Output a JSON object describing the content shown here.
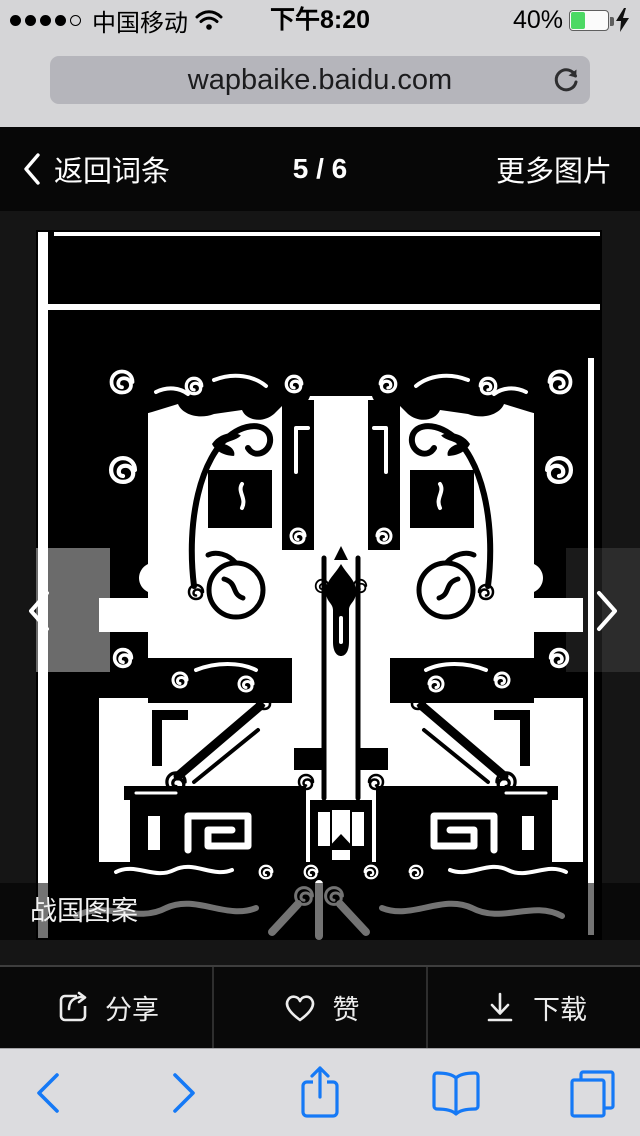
{
  "status_bar": {
    "carrier": "中国移动",
    "time": "下午8:20",
    "battery_percent": "40%",
    "battery_level": 0.4,
    "signal": {
      "filled": 4,
      "total": 5
    },
    "icons": [
      "signal-dots",
      "wifi-icon",
      "battery-icon",
      "charging-bolt-icon"
    ]
  },
  "address_bar": {
    "url": "wapbaike.baidu.com",
    "icons": [
      "refresh-icon"
    ]
  },
  "gallery_header": {
    "back_label": "返回词条",
    "counter": "5 / 6",
    "more_images_label": "更多图片",
    "icons": [
      "chevron-left-icon"
    ]
  },
  "image_viewer": {
    "caption": "战国图案",
    "nav_icons": [
      "chevron-left-icon",
      "chevron-right-icon"
    ],
    "image_description": "black-and-white symmetrical Warring States ornament scan"
  },
  "action_bar": {
    "share_label": "分享",
    "like_label": "赞",
    "download_label": "下载",
    "icons": [
      "share-box-icon",
      "heart-icon",
      "download-icon"
    ]
  },
  "safari_toolbar": {
    "icons": [
      "back-chevron-icon",
      "forward-chevron-icon",
      "share-icon",
      "bookmarks-icon",
      "tabs-icon"
    ]
  },
  "colors": {
    "accent_blue": "#1579f6",
    "battery_green": "#4cd964",
    "chrome_gray": "#d5d5d7",
    "field_gray": "#b5b5bb",
    "page_black": "#151515",
    "bar_black": "#070707"
  }
}
